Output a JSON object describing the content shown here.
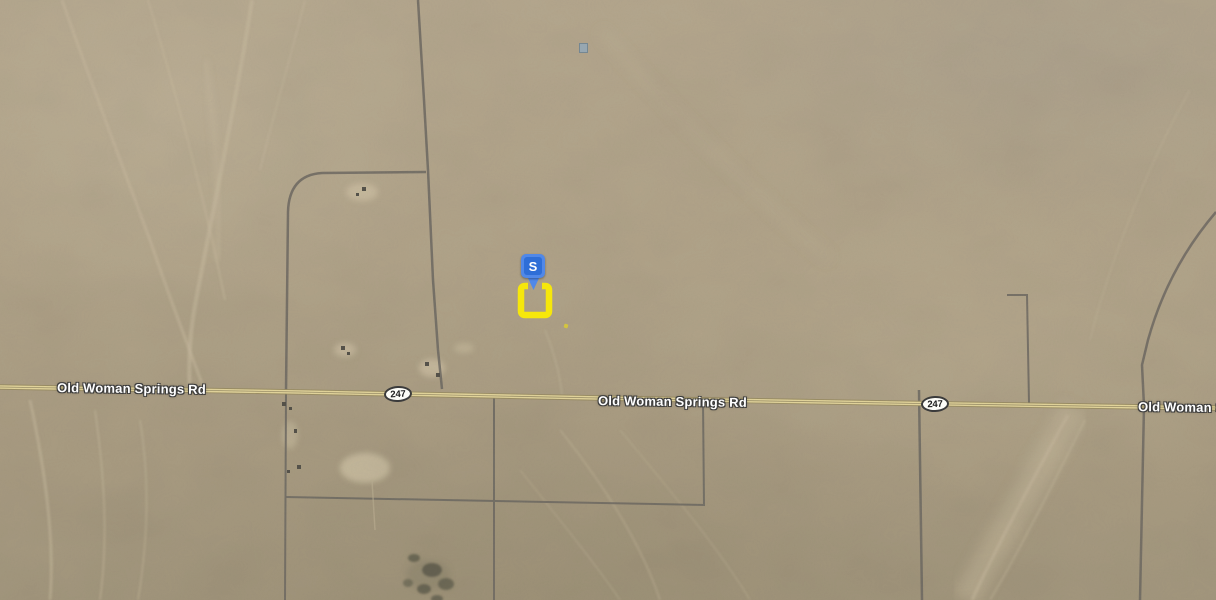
{
  "map": {
    "road_labels": [
      {
        "text": "Old Woman Springs Rd"
      },
      {
        "text": "Old Woman Springs Rd"
      },
      {
        "text": "Old Woman Springs Rd"
      }
    ],
    "route_shields": [
      {
        "text": "247"
      },
      {
        "text": "247"
      }
    ],
    "marker": {
      "label": "S"
    },
    "colors": {
      "marker_blue": "#4285f4",
      "parcel_yellow": "#f6e70b",
      "road_yellow": "#e6d89e",
      "terrain_tan": "#b0a289"
    }
  }
}
